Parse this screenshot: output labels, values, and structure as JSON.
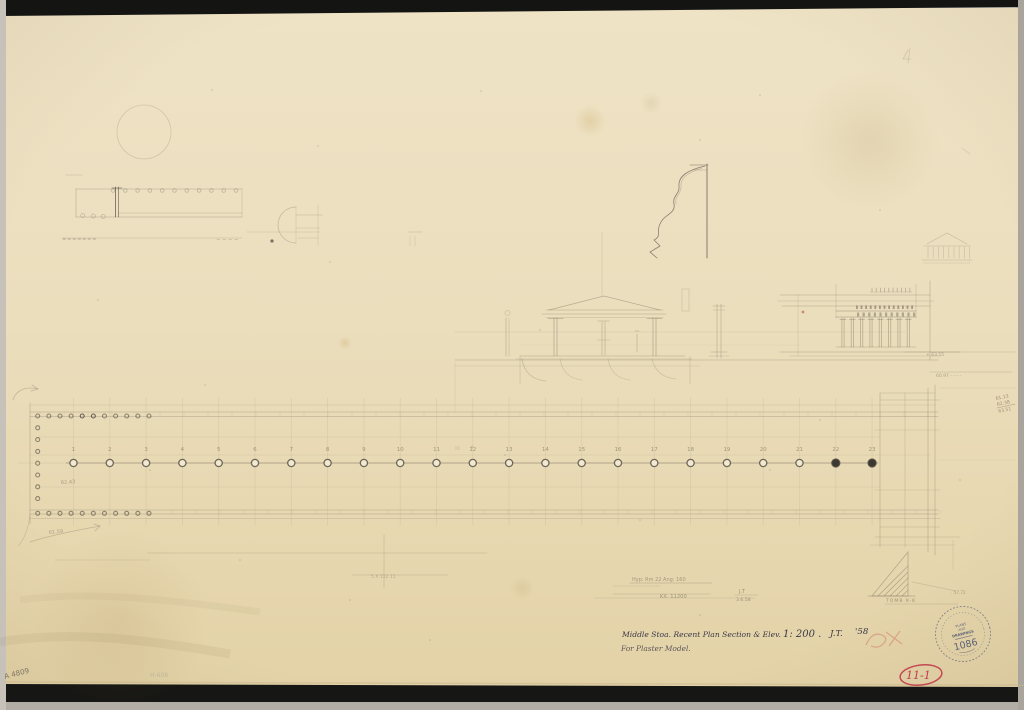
{
  "document": {
    "kind": "scanned architectural pencil drawing",
    "subject": "Middle Stoa plan, section and elevation sketch on aged tracing paper"
  },
  "title_block": {
    "line1": "Middle Stoa.  Recent Plan Section & Elev.",
    "scale": "1: 200 .",
    "initials": "J.T.",
    "year": "'58",
    "line2": "For Plaster Model."
  },
  "stamp": {
    "top": "PLANS",
    "mid": "AND",
    "bottom": "DRAWINGS",
    "number": "1086"
  },
  "marks": {
    "catalog_number": "A 4809",
    "page_number": "11-1",
    "tomb_label": "TOMB K-K",
    "elev_top": "+ 63.55",
    "elev_mid": "60.97 - - - -",
    "elev_small": ". 57.72",
    "west_elev_upper": "62.43",
    "west_elev_lower": "61.59",
    "note_row1": "Hyp: Rm 22   Ang: 160",
    "note_kx": "KX. 11200",
    "note_initials": "J.T",
    "note_date": "3.6.58",
    "faint_note": "5 X 112 11",
    "faint_corner": "H-608",
    "calc_line1": "61.13",
    "calc_line2": "62.38",
    "calc_line3": "63.51"
  },
  "plan": {
    "column_numbers": [
      "1",
      "2",
      "3",
      "4",
      "5",
      "6",
      "7",
      "8",
      "9",
      "10",
      "11",
      "12",
      "13",
      "14",
      "15",
      "16",
      "17",
      "18",
      "19",
      "20",
      "21",
      "22",
      "23"
    ],
    "filled_columns": [
      22,
      23
    ]
  },
  "colors": {
    "paper": "#ebdebd",
    "pencil": "#857c69",
    "ink": "#3a3845",
    "red": "#c13a49",
    "stamp_ink": "#4c5472"
  }
}
